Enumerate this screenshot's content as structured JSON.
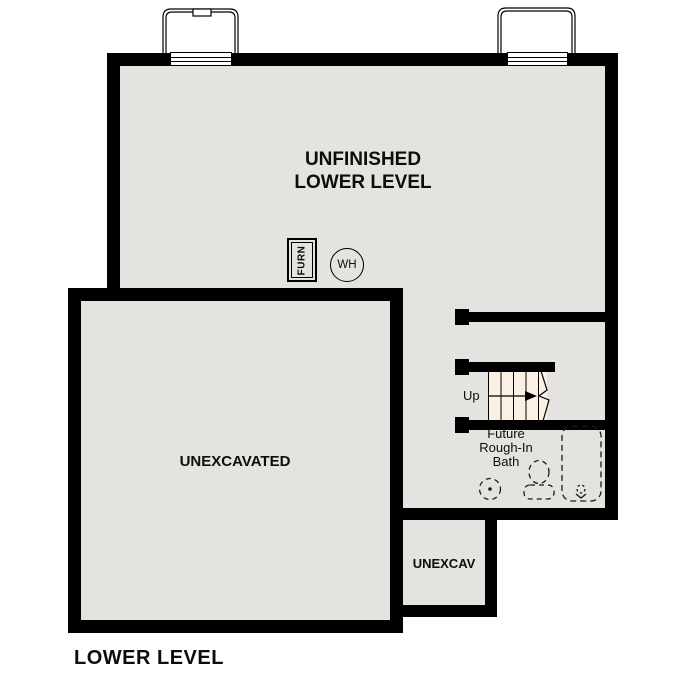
{
  "plan": {
    "title": "LOWER LEVEL",
    "rooms": {
      "unfinished_lower_level": {
        "name_line1": "UNFINISHED",
        "name_line2": "LOWER LEVEL"
      },
      "unexcavated": {
        "name": "UNEXCAVATED"
      },
      "unexcav": {
        "name": "UNEXCAV"
      },
      "future_bath": {
        "name_line1": "Future",
        "name_line2": "Rough-In",
        "name_line3": "Bath",
        "fixtures": [
          "floor-drain",
          "toilet",
          "bathtub"
        ]
      },
      "stairs": {
        "direction": "Up",
        "tread_count": 4
      }
    },
    "equipment": {
      "furnace": "FURN",
      "water_heater": "WH"
    },
    "features": {
      "window_wells": 2,
      "windows": 2
    }
  },
  "colors": {
    "wall": "#000000",
    "floor": "#e4e3e0",
    "stair_fill": "#faf0e4",
    "background": "#ffffff",
    "text": "#0d0d0d"
  }
}
